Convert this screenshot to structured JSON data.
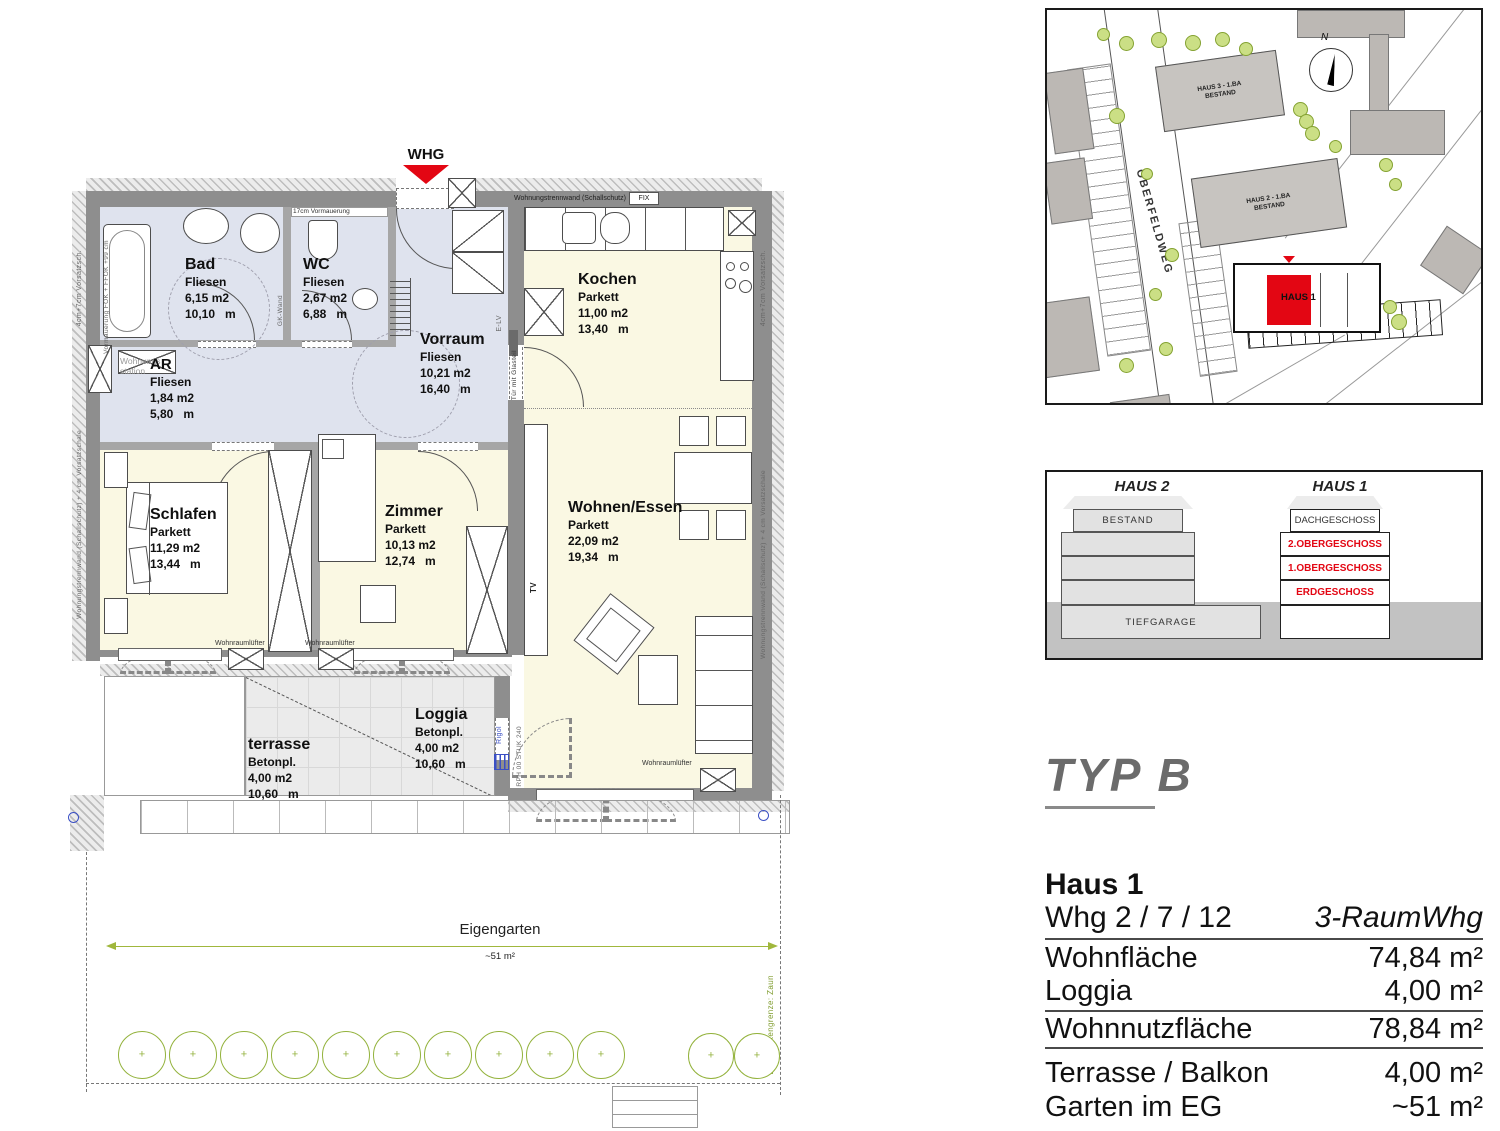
{
  "colors": {
    "accent_red": "#e30613",
    "wet_room_fill": "#dfe3ee",
    "living_fill": "#faf8e3",
    "garden_green": "#93b23c"
  },
  "plan": {
    "entry_label": "WHG",
    "rooms": [
      {
        "name": "Bad",
        "floor": "Fliesen",
        "area": "6,15 m2",
        "len": "10,10   m"
      },
      {
        "name": "WC",
        "floor": "Fliesen",
        "area": "2,67 m2",
        "len": "6,88   m"
      },
      {
        "name": "Vorraum",
        "floor": "Fliesen",
        "area": "10,21 m2",
        "len": "16,40   m"
      },
      {
        "name": "AR",
        "floor": "Fliesen",
        "area": "1,84 m2",
        "len": "5,80   m"
      },
      {
        "name": "Kochen",
        "floor": "Parkett",
        "area": "11,00 m2",
        "len": "13,40   m"
      },
      {
        "name": "Schlafen",
        "floor": "Parkett",
        "area": "11,29 m2",
        "len": "13,44   m"
      },
      {
        "name": "Zimmer",
        "floor": "Parkett",
        "area": "10,13 m2",
        "len": "12,74   m"
      },
      {
        "name": "Wohnen/Essen",
        "floor": "Parkett",
        "area": "22,09 m2",
        "len": "19,34   m"
      },
      {
        "name": "Loggia",
        "floor": "Betonpl.",
        "area": "4,00 m2",
        "len": "10,60   m"
      },
      {
        "name": "terrasse",
        "floor": "Betonpl.",
        "area": "4,00 m2",
        "len": "10,60   m"
      }
    ],
    "labels": {
      "trennwand_top": "Wohnungstrennwand (Schallschutz)",
      "fix": "FIX",
      "vormauerung17": "17cm Vormauerung",
      "gk_wand": "GK-Wand",
      "e_lv": "E-LV",
      "tuer_glas": "Tür mit Glasteil",
      "wohnraumluefter": "Wohnraumlüfter",
      "wohnungsstation": "Wohnungs station",
      "tv": "TV",
      "rigol": "Rigol",
      "rph": "RPH 00  STUK 240",
      "vorsatz": "4cm+7cm Vorsatzsch.",
      "trennwand_seite": "Wohnungstrennwand (Schallschutz) + 4 cm Vorsatzschale",
      "vormauerung_bad": "Vormauerung FOK + FFOK +99 cm"
    },
    "garden": {
      "title": "Eigengarten",
      "size": "~51 m²",
      "boundary": "Eigengartengrenze: Zaun"
    }
  },
  "siteplan": {
    "haus3_line1": "HAUS 3 - 1.BA",
    "haus3_line2": "BESTAND",
    "haus2_line1": "HAUS 2 - 1.BA",
    "haus2_line2": "BESTAND",
    "haus1": "HAUS 1",
    "street": "OBERFELDWEG",
    "north": "N"
  },
  "section": {
    "haus2": "HAUS 2",
    "haus1": "HAUS 1",
    "bestand": "BESTAND",
    "dach": "DACHGESCHOSS",
    "og2": "2.OBERGESCHOSS",
    "og1": "1.OBERGESCHOSS",
    "eg": "ERDGESCHOSS",
    "tiefgarage": "TIEFGARAGE"
  },
  "info": {
    "typ": "TYP B",
    "haus": "Haus 1",
    "whg": "Whg 2 / 7 / 12",
    "typ_desc": "3-RaumWhg",
    "rows": [
      {
        "label": "Wohnfläche",
        "value": "74,84 m²"
      },
      {
        "label": "Loggia",
        "value": "4,00 m²"
      },
      {
        "label": "Wohnnutzfläche",
        "value": "78,84 m²"
      },
      {
        "label": "Terrasse / Balkon",
        "value": "4,00 m²"
      },
      {
        "label": "Garten im EG",
        "value": "~51 m²"
      }
    ]
  }
}
